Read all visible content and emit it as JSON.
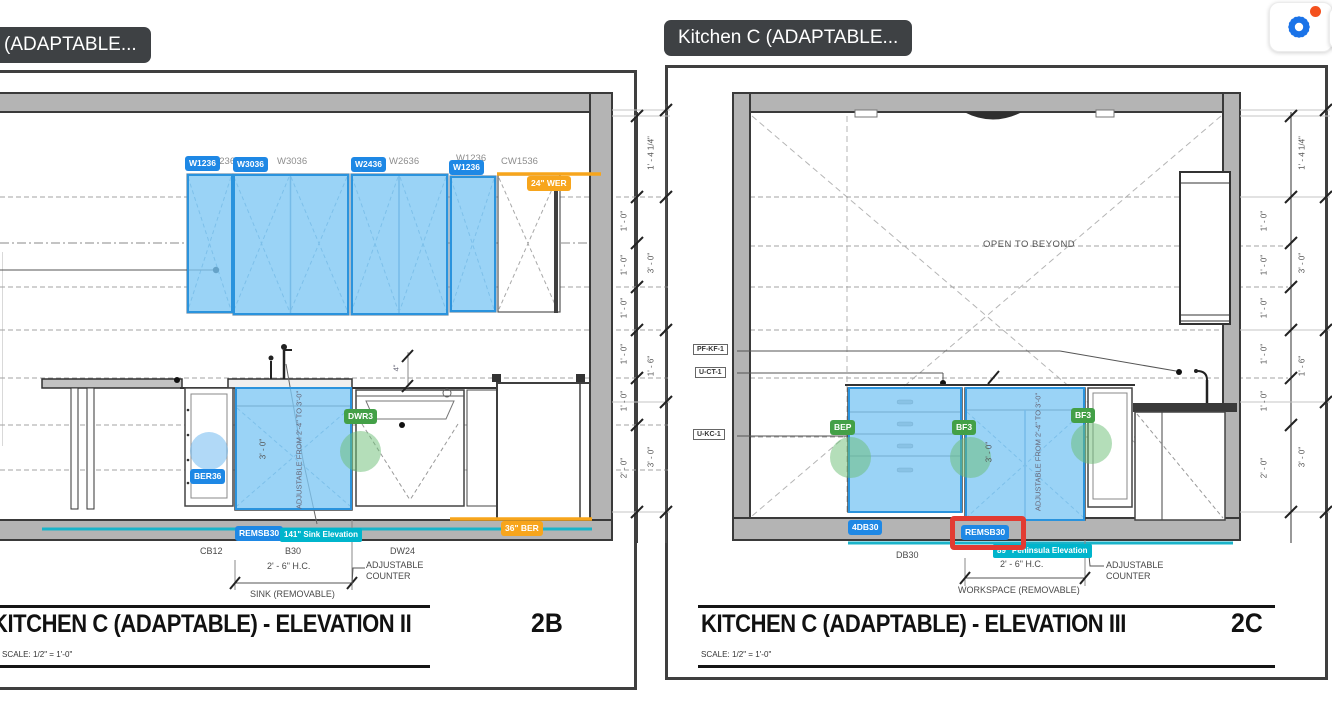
{
  "ui": {
    "tooltip_left": "(ADAPTABLE...",
    "tooltip_right": "Kitchen C (ADAPTABLE...",
    "settings_icon": "gear-with-notification",
    "colors": {
      "chip_blue": "#1e88e5",
      "chip_green": "#43a047",
      "chip_orange": "#f7a51c",
      "flag_cyan": "#00b5cc",
      "line_cyan": "#1ab3c9",
      "highlight_blue": "#7dc6f3",
      "highlight_border": "#2a93dd",
      "selection_red": "#e23b32",
      "tooltip_bg": "#3e4144",
      "gear_blue": "#1a73e8",
      "notification_red": "#f4511e"
    }
  },
  "left_view": {
    "title": "KITCHEN C (ADAPTABLE) - ELEVATION II",
    "scale_note": "SCALE: 1/2\" = 1'-0\"",
    "sheet_ref": "2B",
    "wall_labels": [
      "W1236",
      "W3036",
      "W2636",
      "W1236",
      "CW1536"
    ],
    "chips": {
      "c1": "W1236",
      "c2": "W3036",
      "c3": "W2436",
      "c4": "W1236",
      "wer": "24\" WER",
      "ber36": "BER36",
      "dwr3": "DWR3",
      "remsb30": "REMSB30",
      "ber": "36\" BER"
    },
    "flag_sink": "141\" Sink Elevation",
    "labels": {
      "cb12": "CB12",
      "b30": "B30",
      "dw24": "DW24",
      "hc": "2' - 6\" H.C.",
      "adj_counter": "ADJUSTABLE COUNTER",
      "sink_note": "SINK (REMOVABLE)",
      "three_ft": "3' - 0\"",
      "adj_range": "ADJUSTABLE FROM 2'-4\" TO 3'-0\"",
      "four_in": "4\""
    },
    "dims_inner": [
      "1' - 0\"",
      "1' - 0\"",
      "1' - 0\"",
      "1' - 0\"",
      "1' - 0\"",
      "2' - 0\""
    ],
    "dims_outer": [
      "1' - 4 1/4\"",
      "3' - 0\"",
      "1' - 6\"",
      "3' - 0\""
    ]
  },
  "right_view": {
    "title": "KITCHEN C (ADAPTABLE) - ELEVATION III",
    "scale_note": "SCALE: 1/2\" = 1'-0\"",
    "sheet_ref": "2C",
    "open_note": "OPEN TO BEYOND",
    "ref_tags": [
      "PF-KF-1",
      "U-CT-1",
      "U-KC-1"
    ],
    "chips": {
      "bep": "BEP",
      "bf3a": "BF3",
      "bf3b": "BF3",
      "db": "4DB30",
      "remsb30": "REMSB30"
    },
    "flag_peninsula": "89\" Peninsula Elevation",
    "labels": {
      "db30": "DB30",
      "hc": "2' - 6\" H.C.",
      "adj_counter": "ADJUSTABLE COUNTER",
      "workspace": "WORKSPACE (REMOVABLE)",
      "three_ft": "3' - 0\"",
      "adj_range": "ADJUSTABLE FROM 2'-4\" TO 3'-0\""
    },
    "dims_inner": [
      "1' - 0\"",
      "1' - 0\"",
      "1' - 0\"",
      "1' - 0\"",
      "1' - 0\"",
      "2' - 0\""
    ],
    "dims_outer": [
      "1' - 4 1/4\"",
      "3' - 0\"",
      "1' - 6\"",
      "3' - 0\""
    ]
  }
}
